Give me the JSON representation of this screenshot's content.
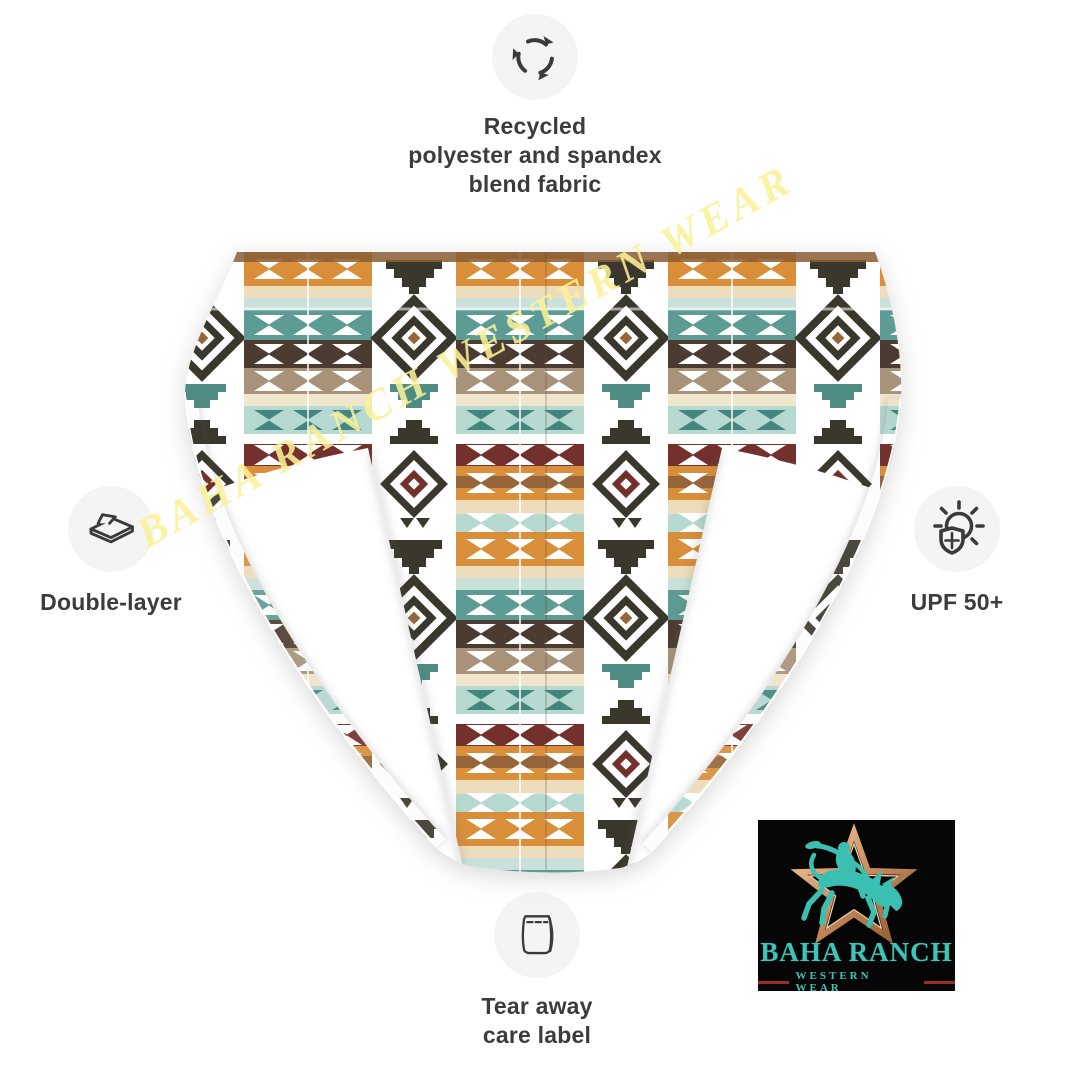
{
  "features": {
    "recycled": {
      "icon": "recycle-icon",
      "lines": [
        "Recycled",
        "polyester and spandex",
        "blend fabric"
      ]
    },
    "double_layer": {
      "icon": "double-layer-icon",
      "label": "Double-layer"
    },
    "upf": {
      "icon": "sun-shield-icon",
      "label": "UPF 50+"
    },
    "care_label": {
      "icon": "care-label-icon",
      "lines": [
        "Tear away",
        "care label"
      ]
    }
  },
  "watermark": {
    "text": "BAHA RANCH WESTERN WEAR",
    "color": "#f9f098"
  },
  "logo": {
    "brand": "BAHA RANCH",
    "tagline": "WESTERN WEAR",
    "colors": {
      "teal": "#3ec4b8",
      "copper": "#c98d5e",
      "background": "#060606",
      "accent_red": "#9b2d22"
    }
  },
  "palette": {
    "caption_text": "#3c3c3c",
    "icon_circle_bg": "#f4f4f4",
    "pattern_orange": "#d98f3a",
    "pattern_brown_stripe": "#96663a",
    "pattern_cream": "#eeddba",
    "pattern_light_aqua": "#b5d8d1",
    "pattern_teal": "#5d9c94",
    "pattern_dark_brown": "#4c3b30",
    "pattern_khaki": "#a8937a",
    "pattern_maroon": "#73302c",
    "pattern_medallion_dark": "#3a372d"
  }
}
